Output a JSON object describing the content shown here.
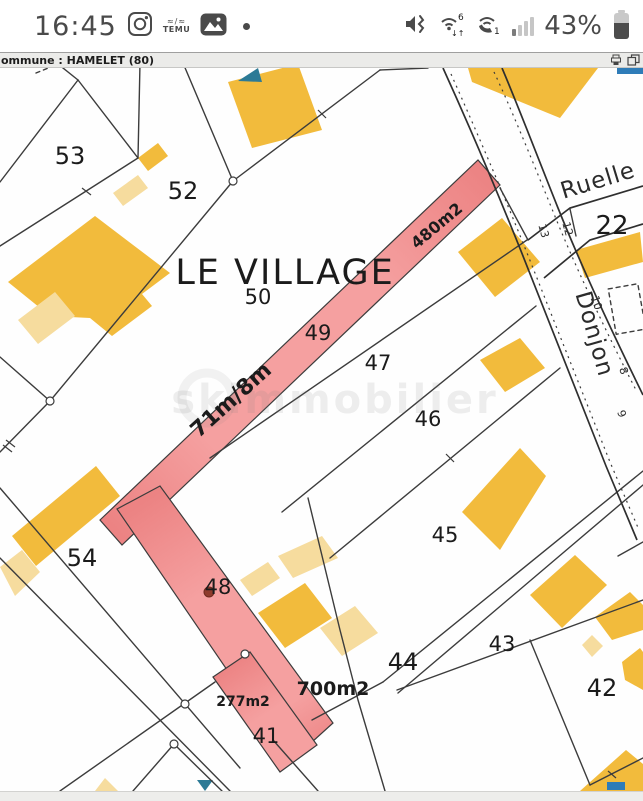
{
  "status_bar": {
    "time": "16:45",
    "battery_percent": "43%",
    "temu_label": "TEMU"
  },
  "browser_bar": {
    "title": "ommune : HAMELET (80)"
  },
  "map": {
    "title": "LE VILLAGE",
    "watermark": "skimmobilier",
    "streets": {
      "ruelle": "Ruelle",
      "donjon": "Donjon"
    },
    "parcels": {
      "p22": "22",
      "p41": "41",
      "p42": "42",
      "p43": "43",
      "p44": "44",
      "p45": "45",
      "p46": "46",
      "p47": "47",
      "p48": "48",
      "p49": "49",
      "p50": "50",
      "p52": "52",
      "p53": "53",
      "p54": "54"
    },
    "listings": {
      "area1": "480m2",
      "dims1": "71m/8m",
      "area2": "700m2",
      "area3": "277m2"
    },
    "house_numbers": {
      "n13": "13",
      "n12": "12",
      "n10": "10",
      "n8": "8",
      "n9": "9"
    }
  },
  "colors": {
    "status": "#4a4a4a",
    "line": "#3c3c3c",
    "label": "#1b1b1b",
    "yellow": "#F2BB3C",
    "cream": "#F6DC9E",
    "pink": "#F5A0A0",
    "pinkdark": "#EC8383",
    "teal": "#2C7A96",
    "blue": "#2E7CB8",
    "reddot": "#8F3B2C"
  }
}
